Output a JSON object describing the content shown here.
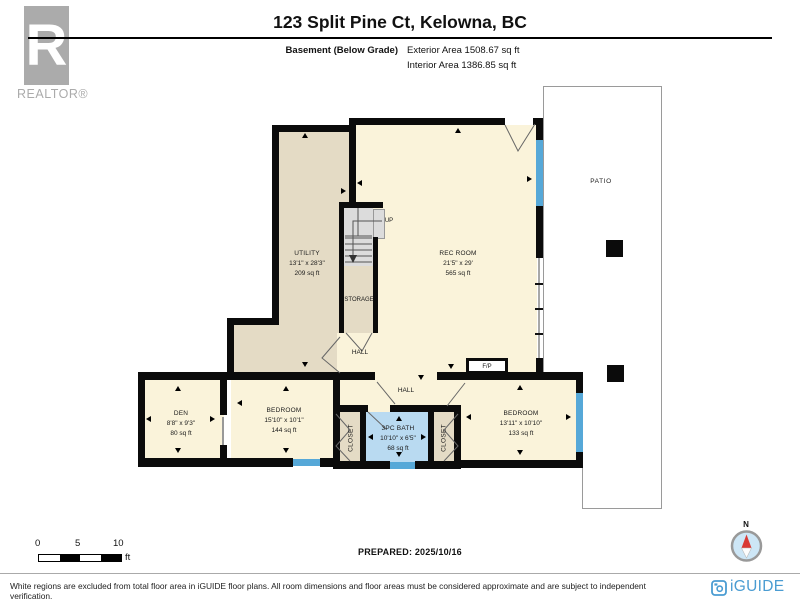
{
  "header": {
    "logo_letter": "R",
    "logo_word": "REALTOR®",
    "title": "123 Split Pine Ct, Kelowna, BC",
    "floor_label": "Basement (Below Grade)",
    "exterior_area": "Exterior Area 1508.67 sq ft",
    "interior_area": "Interior Area 1386.85 sq ft"
  },
  "rooms": {
    "utility": {
      "name": "UTILITY",
      "dims": "13'1\" x 28'3\"",
      "area": "209 sq ft"
    },
    "rec_room": {
      "name": "REC ROOM",
      "dims": "21'5\" x 29'",
      "area": "565 sq ft"
    },
    "storage": {
      "name": "STORAGE"
    },
    "stairs": {
      "label": "UP"
    },
    "hall_upper": {
      "name": "HALL"
    },
    "hall_lower": {
      "name": "HALL"
    },
    "fireplace": {
      "name": "F/P"
    },
    "den": {
      "name": "DEN",
      "dims": "8'8\" x 9'3\"",
      "area": "80 sq ft"
    },
    "bedroom_left": {
      "name": "BEDROOM",
      "dims": "15'10\" x 10'1\"",
      "area": "144 sq ft"
    },
    "closet_left": {
      "name": "CLOSET"
    },
    "bath": {
      "name": "3PC BATH",
      "dims": "10'10\" x 6'5\"",
      "area": "68 sq ft"
    },
    "closet_right": {
      "name": "CLOSET"
    },
    "bedroom_right": {
      "name": "BEDROOM",
      "dims": "13'11\" x 10'10\"",
      "area": "133 sq ft"
    },
    "patio": {
      "name": "PATIO"
    }
  },
  "scale_bar": {
    "ticks": [
      "0",
      "5",
      "10"
    ],
    "unit": "ft"
  },
  "compass": {
    "label": "N"
  },
  "footer": {
    "prepared": "PREPARED: 2025/10/16",
    "disclaimer": "White regions are excluded from total floor area in iGUIDE floor plans. All room dimensions and floor areas must be considered approximate and are subject to independent verification.",
    "brand": "iGUIDE"
  },
  "colors": {
    "room_cream": "#FAF3DA",
    "room_tan": "#E4DBC5",
    "bath_blue": "#B9DAF1",
    "window_blue": "#56A8D8",
    "wall_black": "#0B0B0B",
    "brand_blue": "#4A9CD2",
    "compass_red": "#D93A35",
    "logo_gray": "#ABABAB"
  }
}
